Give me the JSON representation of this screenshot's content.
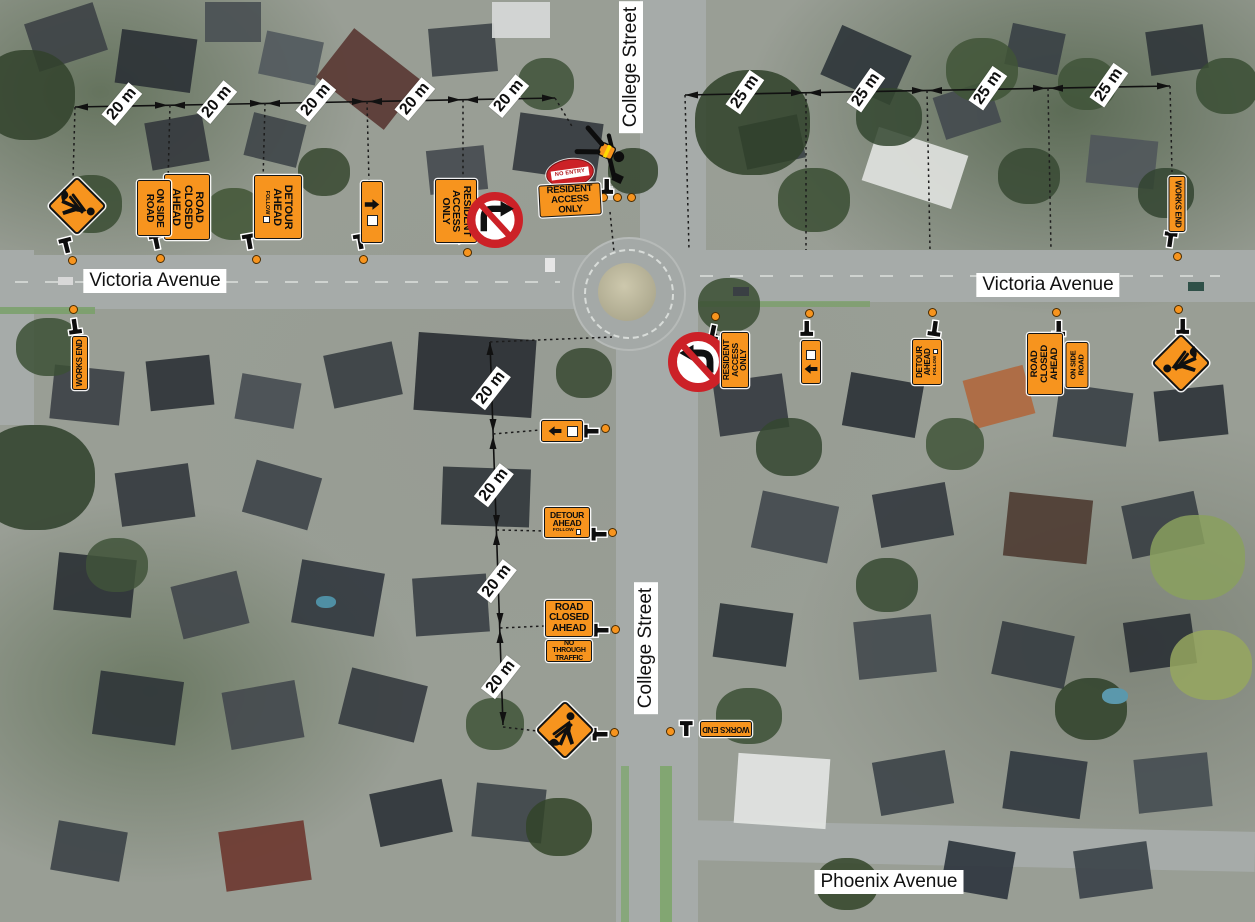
{
  "streets": {
    "college_top_label": "College Street",
    "college_south_label": "College Street",
    "victoria_west_label": "Victoria Avenue",
    "victoria_east_label": "Victoria Avenue",
    "phoenix_label": "Phoenix Avenue"
  },
  "dimension_lines": {
    "victoria_west": {
      "label": "20 m",
      "segments": 5
    },
    "victoria_east": {
      "label": "25 m",
      "segments": 4
    },
    "college_street": {
      "label": "20 m",
      "segments": 4
    }
  },
  "sign_text": {
    "road_closed_ahead": [
      "ROAD",
      "CLOSED",
      "AHEAD"
    ],
    "on_side_road": [
      "ON SIDE",
      "ROAD"
    ],
    "detour_ahead": [
      "DETOUR",
      "AHEAD"
    ],
    "follow": "FOLLOW",
    "resident_access_only": [
      "RESIDENT",
      "ACCESS ONLY"
    ],
    "no_through_traffic": [
      "NO THROUGH",
      "TRAFFIC"
    ],
    "no_entry": "NO ENTRY",
    "works_end": "WORKS END"
  },
  "icons": {
    "roadworks_symbol": "worker-digging-symbol",
    "no_right_turn": "no-right-turn-symbol",
    "no_left_turn": "no-left-turn-symbol",
    "traffic_controller": "traffic-controller-figure",
    "detour_arrow_right": "arrow-right",
    "detour_arrow_left": "arrow-left",
    "post_marker": "t-post-icon",
    "cone_marker": "orange-dot"
  },
  "colors": {
    "sign_orange": "#F7941E",
    "prohibition_red": "#CC2127",
    "label_background": "#FFFFFF",
    "line_black": "#111111"
  }
}
